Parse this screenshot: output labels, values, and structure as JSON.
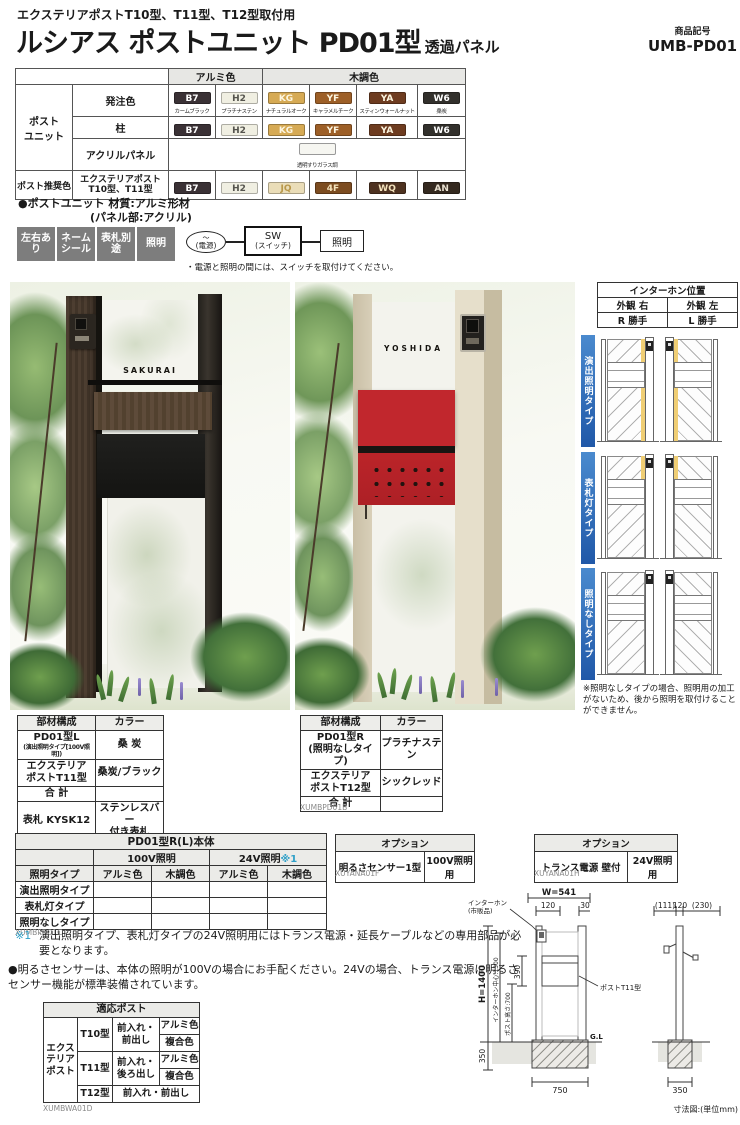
{
  "header": {
    "usage_note": "エクステリアポストT10型、T11型、T12型取付用",
    "title": "ルシアス ポストユニット PD01型",
    "title_suffix": "透過パネル",
    "product_code_label": "商品記号",
    "product_code": "UMB-PD01"
  },
  "color_table": {
    "alumi_header": "アルミ色",
    "wood_header": "木調色",
    "post_unit_label": "ポスト\nユニット",
    "recommend_label": "ポスト推奨色",
    "order_label": "発注色",
    "pillar_label": "柱",
    "acrylic_label": "アクリルパネル",
    "recommend_row_label": "エクステリアポスト\nT10型、T11型",
    "acrylic_swatch_label": "透明すりガラス調",
    "acrylic_bg": "#f6f6f1",
    "order_swatches": [
      {
        "code": "B7",
        "name": "カームブラック",
        "bg": "#3a3135",
        "fg": "#ffffff"
      },
      {
        "code": "H2",
        "name": "プラチナステン",
        "bg": "#f0efe2",
        "fg": "#55544e"
      },
      {
        "code": "KG",
        "name": "ナチュラルオーク",
        "bg": "#d6aa54",
        "fg": "#fdf6e0"
      },
      {
        "code": "YF",
        "name": "キャラメルチーク",
        "bg": "#9d5f27",
        "fg": "#fdf6e0"
      },
      {
        "code": "YA",
        "name": "スティンウォールナット",
        "bg": "#6e3c20",
        "fg": "#fdf6e0"
      },
      {
        "code": "W6",
        "name": "桑炭",
        "bg": "#32302c",
        "fg": "#ffffff"
      }
    ],
    "pillar_swatches": [
      {
        "code": "B7",
        "bg": "#3a3135",
        "fg": "#ffffff"
      },
      {
        "code": "H2",
        "bg": "#f0efe2",
        "fg": "#55544e"
      },
      {
        "code": "KG",
        "bg": "#d6aa54",
        "fg": "#fdf6e0"
      },
      {
        "code": "YF",
        "bg": "#9d5f27",
        "fg": "#fdf6e0"
      },
      {
        "code": "YA",
        "bg": "#6e3c20",
        "fg": "#fdf6e0"
      },
      {
        "code": "W6",
        "bg": "#32302c",
        "fg": "#ffffff"
      }
    ],
    "recommend_swatches": [
      {
        "code": "B7",
        "bg": "#3a3135",
        "fg": "#ffffff"
      },
      {
        "code": "H2",
        "bg": "#f0efe2",
        "fg": "#55544e"
      },
      {
        "code": "JQ",
        "bg": "#eaddb8",
        "fg": "#b9984a"
      },
      {
        "code": "4F",
        "bg": "#7c4c20",
        "fg": "#f4e3bc"
      },
      {
        "code": "WQ",
        "bg": "#4e3220",
        "fg": "#f4e3bc"
      },
      {
        "code": "AN",
        "bg": "#34291f",
        "fg": "#e8e0d0"
      }
    ]
  },
  "material_note_l1": "●ポストユニット 材質:アルミ形材",
  "material_note_l2": "(パネル部:アクリル)",
  "badges": [
    "左右あり",
    "ネーム\nシール",
    "表札別途",
    "照明"
  ],
  "circuit": {
    "power_top": "〜",
    "power": "(電源)",
    "switch_line1": "SW",
    "switch_line2": "(スイッチ)",
    "light": "照明",
    "note": "・電源と照明の間には、スイッチを取付けてください。"
  },
  "photos": {
    "left_nameplate": "SAKURAI",
    "right_nameplate": "YOSHIDA"
  },
  "interphone": {
    "title": "インターホン位置",
    "col_right": "外観 右",
    "col_left": "外観 左",
    "val_right": "R 勝手",
    "val_left": "L 勝手"
  },
  "lighting_types": [
    {
      "label": "演出照明タイプ"
    },
    {
      "label": "表札灯タイプ"
    },
    {
      "label": "照明なしタイプ"
    }
  ],
  "lighting_note": "※照明なしタイプの場合、照明用の加工がないため、後から照明を取付けることができません。",
  "parts_a": {
    "h_parts": "部材構成",
    "h_color": "カラー",
    "r1_name": "PD01型L",
    "r1_sub": "(演出照明タイプ[100V照明])",
    "r1_color": "桑 炭",
    "r2_name": "エクステリア\nポストT11型",
    "r2_color": "桑炭/ブラック",
    "r3_name": "合 計",
    "r4_name": "表札 KYSK12",
    "r4_color": "ステンレスバー\n付き表札",
    "r5_name": "表札込み価格",
    "caption": "XUMBPD01A"
  },
  "parts_b": {
    "h_parts": "部材構成",
    "h_color": "カラー",
    "r1_name": "PD01型R\n(照明なしタイプ)",
    "r1_color": "プラチナステン",
    "r2_name": "エクステリア\nポストT12型",
    "r2_color": "シックレッド",
    "r3_name": "合 計",
    "caption": "XUMBPD01B"
  },
  "main_table": {
    "title": "PD01型R(L)本体",
    "v100": "100V照明",
    "v24": "24V照明",
    "v24_mark": "※1",
    "col_type": "照明タイプ",
    "col_alumi": "アルミ色",
    "col_wood": "木調色",
    "row1": "演出照明タイプ",
    "row2": "表札灯タイプ",
    "row3": "照明なしタイプ",
    "caption": "XUMBPD01C"
  },
  "option1": {
    "title": "オプション",
    "name": "明るさセンサー1型",
    "use": "100V照明用",
    "caption": "XUYANA01F"
  },
  "option2": {
    "title": "オプション",
    "name": "トランス電源 壁付",
    "use": "24V照明用",
    "caption": "XUYANA01H"
  },
  "notes": {
    "n1_mark": "※1",
    "n1_text": "演出照明タイプ、表札灯タイプの24V照明用にはトランス電源・延長ケーブルなどの専用部品が必要となります。",
    "n2_text": "●明るさセンサーは、本体の照明が100Vの場合にお手配ください。24Vの場合、トランス電源に明るさセンサー機能が標準装備されています。"
  },
  "compat": {
    "title": "適応ポスト",
    "group": "エクステリア\nポスト",
    "t10": "T10型",
    "t10_access": "前入れ・\n前出し",
    "t10_c1": "アルミ色",
    "t10_c2": "複合色",
    "t11": "T11型",
    "t11_access": "前入れ・\n後ろ出し",
    "t11_c1": "アルミ色",
    "t11_c2": "複合色",
    "t12": "T12型",
    "t12_access": "前入れ・前出し",
    "caption": "XUMBWA01D"
  },
  "dimensions": {
    "front_w": "W=541",
    "front_120": "120",
    "front_30": "30",
    "front_h": "H=1400",
    "front_ic_center": "インターホン中心:1300",
    "front_post_h": "ポスト高さ:700",
    "front_390": "390",
    "front_350": "350",
    "front_750": "750",
    "gl": "G.L",
    "interphone_label_1": "インターホン",
    "interphone_label_2": "(市販品)",
    "post_label": "ポストT11型",
    "side_111": "(111)",
    "side_120": "120",
    "side_230": "(230)",
    "side_350": "350",
    "unit_note": "寸法図:(単位mm)"
  },
  "colors": {
    "type_label_blue": "#2e6fb7",
    "note_teal": "#2fa0c8",
    "badge_gray": "#7d7d7d",
    "mail_red": "#c1272d",
    "post_beige": "#ddd5bf",
    "post_darkwood": "#46372c",
    "light_yellow": "#f0ce74"
  }
}
